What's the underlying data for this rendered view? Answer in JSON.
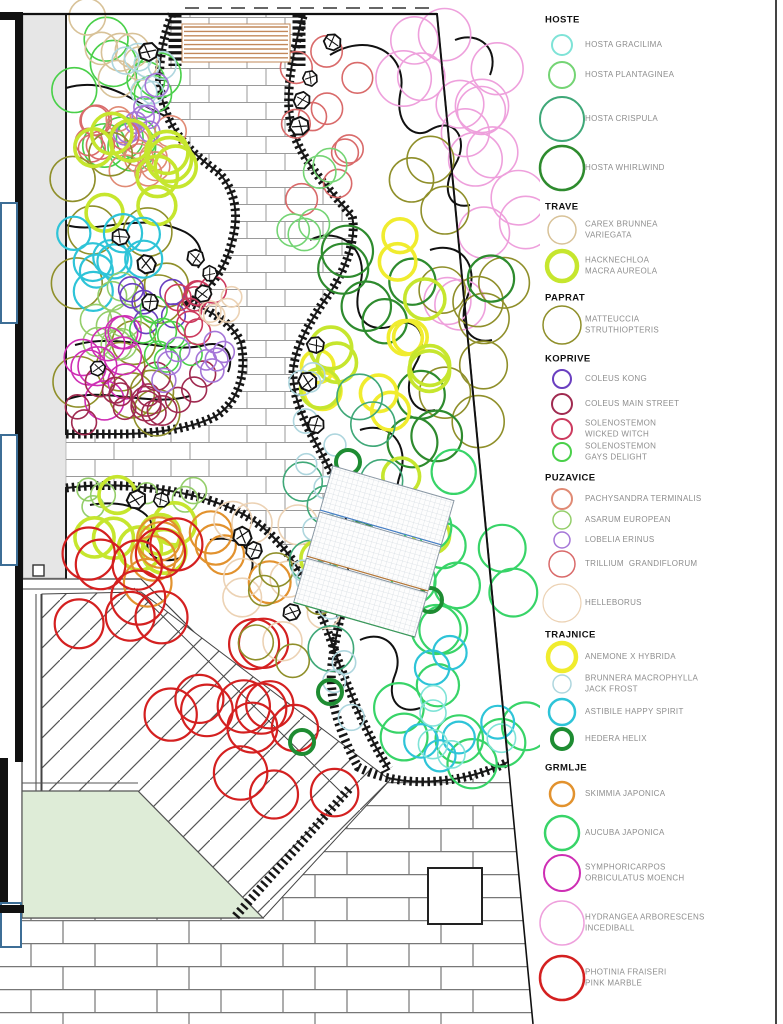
{
  "legend": {
    "sections": [
      {
        "name": "HOSTE",
        "y": 20,
        "items": [
          {
            "id": "gracilima",
            "label": "HOSTA GRACILIMA",
            "y": 45,
            "r": 10,
            "w": 2,
            "color": "#7fe3d7"
          },
          {
            "id": "plantaginea",
            "label": "HOSTA PLANTAGINEA",
            "y": 75,
            "r": 13,
            "w": 2,
            "color": "#74d474"
          },
          {
            "id": "crispula",
            "label": "HOSTA CRISPULA",
            "y": 119,
            "r": 22,
            "w": 2,
            "color": "#3fa878"
          },
          {
            "id": "whirlwind",
            "label": "HOSTA WHIRLWIND",
            "y": 168,
            "r": 22,
            "w": 2.5,
            "color": "#2e8b2e"
          }
        ]
      },
      {
        "name": "TRAVE",
        "y": 207,
        "items": [
          {
            "id": "carex",
            "label": "CAREX BRUNNEA\nVARIEGATA",
            "y": 230,
            "r": 14,
            "w": 1.5,
            "color": "#d8c298"
          },
          {
            "id": "hacknechloa",
            "label": "HACKNECHLOA\nMACRA AUREOLA",
            "y": 266,
            "r": 15,
            "w": 4.5,
            "color": "#c6e62e"
          }
        ]
      },
      {
        "name": "PAPRAT",
        "y": 298,
        "items": [
          {
            "id": "matteuccia",
            "label": "MATTEUCCIA\nSTRUTHIOPTERIS",
            "y": 325,
            "r": 19,
            "w": 1.5,
            "color": "#8f8f2a"
          }
        ]
      },
      {
        "name": "KOPRIVE",
        "y": 359,
        "items": [
          {
            "id": "kong",
            "label": "COLEUS KONG",
            "y": 379,
            "r": 9,
            "w": 2,
            "color": "#6a3fc0"
          },
          {
            "id": "mainstreet",
            "label": "COLEUS MAIN STREET",
            "y": 404,
            "r": 10,
            "w": 2,
            "color": "#a02a50"
          },
          {
            "id": "wicked",
            "label": "SOLENOSTEMON\nWICKED WITCH",
            "y": 429,
            "r": 10,
            "w": 2,
            "color": "#cc3a5e"
          },
          {
            "id": "gays",
            "label": "SOLENOSTEMON\nGAYS DELIGHT",
            "y": 452,
            "r": 9,
            "w": 2,
            "color": "#4ad04a"
          }
        ]
      },
      {
        "name": "PUZAVICE",
        "y": 478,
        "items": [
          {
            "id": "pachysandra",
            "label": "PACHYSANDRA TERMINALIS",
            "y": 499,
            "r": 10,
            "w": 2,
            "color": "#e08a74"
          },
          {
            "id": "asarum",
            "label": "ASARUM EUROPEAN",
            "y": 520,
            "r": 9,
            "w": 1.5,
            "color": "#94ce6a"
          },
          {
            "id": "lobelia",
            "label": "LOBELIA ERINUS",
            "y": 540,
            "r": 8,
            "w": 1.5,
            "color": "#a576d8"
          },
          {
            "id": "trillium",
            "label": "TRILLIUM  GRANDIFLORUM",
            "y": 564,
            "r": 13,
            "w": 1.5,
            "color": "#d96a6a"
          },
          {
            "id": "helleborus",
            "label": "HELLEBORUS",
            "y": 603,
            "r": 19,
            "w": 1.2,
            "color": "#ecd2b4"
          }
        ]
      },
      {
        "name": "TRAJNICE",
        "y": 635,
        "items": [
          {
            "id": "anemone",
            "label": "ANEMONE X HYBRIDA",
            "y": 657,
            "r": 14,
            "w": 4.5,
            "color": "#f0ec2e"
          },
          {
            "id": "brunnera",
            "label": "BRUNNERA MACROPHYLLA\nJACK FROST",
            "y": 684,
            "r": 9,
            "w": 1.5,
            "color": "#aed6de"
          },
          {
            "id": "astibile",
            "label": "ASTIBILE HAPPY SPIRIT",
            "y": 712,
            "r": 13,
            "w": 2.5,
            "color": "#2ec4d8"
          },
          {
            "id": "hedera",
            "label": "HEDERA HELIX",
            "y": 739,
            "r": 10,
            "w": 4,
            "color": "#1e8c32"
          }
        ]
      },
      {
        "name": "GRMLJE",
        "y": 768,
        "items": [
          {
            "id": "skimmia",
            "label": "SKIMMIA JAPONICA",
            "y": 794,
            "r": 12,
            "w": 2.5,
            "color": "#e2922e"
          },
          {
            "id": "aucuba",
            "label": "AUCUBA JAPONICA",
            "y": 833,
            "r": 17,
            "w": 2.5,
            "color": "#38d468"
          },
          {
            "id": "symphoricarpos",
            "label": "SYMPHORICARPOS\nORBICULATUS MOENCH",
            "y": 873,
            "r": 18,
            "w": 2,
            "color": "#ce2eb4"
          },
          {
            "id": "hydrangea",
            "label": "HYDRANGEA ARBORESCENS\nINCEDIBALL",
            "y": 923,
            "r": 22,
            "w": 1.5,
            "color": "#eea0dc"
          },
          {
            "id": "photinia",
            "label": "PHOTINIA FRAISERI\nPINK MARBLE",
            "y": 978,
            "r": 22,
            "w": 2.5,
            "color": "#d42020"
          }
        ]
      }
    ]
  },
  "plan": {
    "clusters": [
      {
        "p": "gays",
        "b": [
          70,
          18,
          160,
          150
        ],
        "n": 10,
        "r": [
          18,
          24
        ]
      },
      {
        "p": "carex",
        "b": [
          85,
          15,
          150,
          92
        ],
        "n": 6,
        "r": [
          15,
          19
        ]
      },
      {
        "p": "brunnera",
        "b": [
          125,
          52,
          172,
          95
        ],
        "n": 6,
        "r": [
          11,
          14
        ]
      },
      {
        "p": "pachysandra",
        "b": [
          92,
          84,
          178,
          188
        ],
        "n": 10,
        "r": [
          12,
          16
        ]
      },
      {
        "p": "lobelia",
        "b": [
          124,
          84,
          172,
          136
        ],
        "n": 8,
        "r": [
          10,
          12
        ]
      },
      {
        "p": "trillium",
        "b": [
          88,
          98,
          152,
          152
        ],
        "n": 6,
        "r": [
          13,
          16
        ]
      },
      {
        "p": "matteuccia",
        "b": [
          68,
          148,
          168,
          428
        ],
        "n": 13,
        "r": [
          21,
          26
        ]
      },
      {
        "p": "hacknechloa",
        "b": [
          92,
          128,
          176,
          235
        ],
        "n": 9,
        "r": [
          18,
          23
        ]
      },
      {
        "p": "astibile",
        "b": [
          68,
          222,
          150,
          292
        ],
        "n": 9,
        "r": [
          16,
          20
        ]
      },
      {
        "p": "asarum",
        "b": [
          66,
          282,
          128,
          346
        ],
        "n": 8,
        "r": [
          14,
          17
        ]
      },
      {
        "p": "symphoricarpos",
        "b": [
          66,
          328,
          138,
          410
        ],
        "n": 9,
        "r": [
          16,
          20
        ]
      },
      {
        "p": "mainstreet",
        "b": [
          68,
          362,
          208,
          430
        ],
        "n": 15,
        "r": [
          11,
          15
        ]
      },
      {
        "p": "kong",
        "b": [
          128,
          286,
          178,
          324
        ],
        "n": 6,
        "r": [
          10,
          13
        ]
      },
      {
        "p": "gays",
        "b": [
          143,
          303,
          192,
          362
        ],
        "n": 7,
        "r": [
          11,
          14
        ]
      },
      {
        "p": "wicked",
        "b": [
          170,
          283,
          222,
          342
        ],
        "n": 8,
        "r": [
          11,
          14
        ]
      },
      {
        "p": "lobelia",
        "b": [
          163,
          338,
          224,
          384
        ],
        "n": 8,
        "r": [
          10,
          12
        ]
      },
      {
        "p": "helleborus",
        "b": [
          203,
          286,
          238,
          320
        ],
        "n": 4,
        "r": [
          10,
          12
        ]
      },
      {
        "p": "asarum",
        "b": [
          84,
          485,
          200,
          516
        ],
        "n": 6,
        "r": [
          10,
          13
        ]
      },
      {
        "p": "hacknechloa",
        "b": [
          70,
          494,
          178,
          568
        ],
        "n": 7,
        "r": [
          18,
          22
        ]
      },
      {
        "p": "skimmia",
        "b": [
          128,
          518,
          292,
          612
        ],
        "n": 8,
        "r": [
          19,
          24
        ]
      },
      {
        "p": "photinia",
        "b": [
          68,
          538,
          200,
          642
        ],
        "n": 8,
        "r": [
          23,
          27
        ]
      },
      {
        "p": "photinia",
        "b": [
          148,
          608,
          282,
          722
        ],
        "n": 7,
        "r": [
          23,
          27
        ]
      },
      {
        "p": "photinia",
        "b": [
          228,
          688,
          355,
          795
        ],
        "n": 7,
        "r": [
          23,
          27
        ]
      },
      {
        "p": "helleborus",
        "b": [
          226,
          518,
          334,
          642
        ],
        "n": 8,
        "r": [
          16,
          20
        ]
      },
      {
        "p": "matteuccia",
        "b": [
          246,
          558,
          332,
          662
        ],
        "n": 5,
        "r": [
          15,
          18
        ]
      },
      {
        "p": "trillium",
        "b": [
          288,
          24,
          362,
          218
        ],
        "n": 10,
        "r": [
          13,
          16
        ]
      },
      {
        "p": "hydrangea",
        "b": [
          352,
          14,
          532,
          122
        ],
        "n": 8,
        "r": [
          23,
          28
        ]
      },
      {
        "p": "hydrangea",
        "b": [
          428,
          100,
          535,
          305
        ],
        "n": 8,
        "r": [
          23,
          28
        ]
      },
      {
        "p": "matteuccia",
        "b": [
          388,
          108,
          522,
          445
        ],
        "n": 10,
        "r": [
          22,
          27
        ]
      },
      {
        "p": "whirlwind",
        "b": [
          338,
          228,
          502,
          562
        ],
        "n": 10,
        "r": [
          22,
          26
        ]
      },
      {
        "p": "anemone",
        "b": [
          288,
          233,
          422,
          478
        ],
        "n": 8,
        "r": [
          16,
          19
        ]
      },
      {
        "p": "hacknechloa",
        "b": [
          298,
          268,
          432,
          562
        ],
        "n": 9,
        "r": [
          18,
          22
        ]
      },
      {
        "p": "crispula",
        "b": [
          288,
          388,
          432,
          652
        ],
        "n": 10,
        "r": [
          19,
          23
        ]
      },
      {
        "p": "aucuba",
        "b": [
          383,
          443,
          527,
          772
        ],
        "n": 16,
        "r": [
          21,
          25
        ]
      },
      {
        "p": "brunnera",
        "b": [
          298,
          333,
          346,
          562
        ],
        "n": 10,
        "r": [
          10,
          13
        ]
      },
      {
        "p": "brunnera",
        "b": [
          298,
          560,
          362,
          742
        ],
        "n": 8,
        "r": [
          10,
          13
        ]
      },
      {
        "p": "astibile",
        "b": [
          388,
          648,
          522,
          766
        ],
        "n": 6,
        "r": [
          15,
          18
        ]
      },
      {
        "p": "gracilima",
        "b": [
          418,
          688,
          522,
          762
        ],
        "n": 5,
        "r": [
          12,
          15
        ]
      },
      {
        "p": "plantaginea",
        "b": [
          290,
          120,
          352,
          242
        ],
        "n": 5,
        "r": [
          14,
          17
        ]
      }
    ],
    "hedera_circles": [
      [
        348,
        462
      ],
      [
        418,
        517
      ],
      [
        430,
        600
      ],
      [
        330,
        692
      ],
      [
        302,
        742
      ]
    ],
    "rocks": [
      [
        148,
        52,
        1
      ],
      [
        332,
        42,
        0.9
      ],
      [
        310,
        78,
        0.8
      ],
      [
        302,
        100,
        0.9
      ],
      [
        300,
        126,
        1
      ],
      [
        196,
        258,
        0.9
      ],
      [
        210,
        274,
        0.8
      ],
      [
        203,
        294,
        0.9
      ],
      [
        120,
        237,
        0.9
      ],
      [
        146,
        264,
        1
      ],
      [
        150,
        302,
        0.9
      ],
      [
        98,
        368,
        0.8
      ],
      [
        316,
        345,
        0.9
      ],
      [
        308,
        382,
        1
      ],
      [
        316,
        425,
        0.9
      ],
      [
        136,
        500,
        1
      ],
      [
        161,
        500,
        0.8
      ],
      [
        242,
        536,
        1
      ],
      [
        254,
        550,
        0.9
      ],
      [
        292,
        612,
        0.9
      ]
    ],
    "bench_slats": 8
  }
}
